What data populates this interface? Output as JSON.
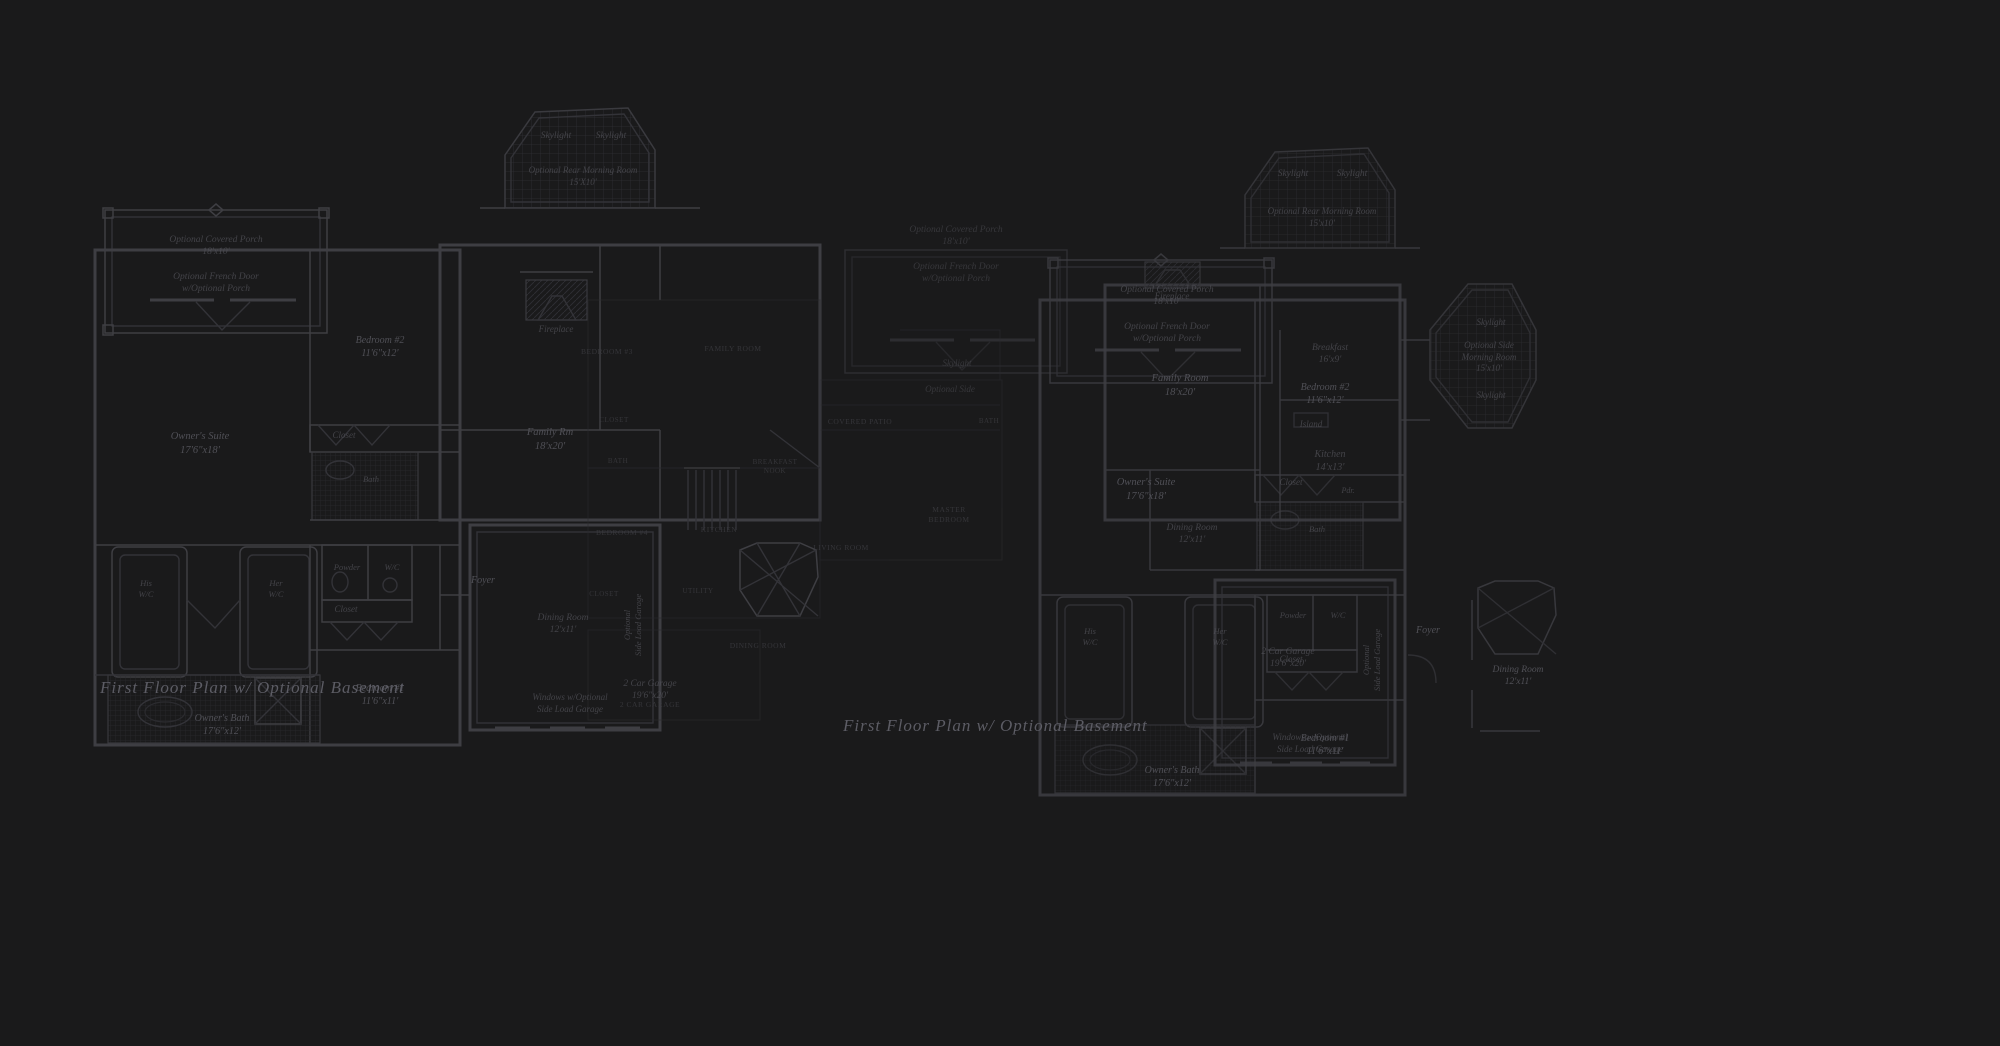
{
  "canvas": {
    "width": 2000,
    "height": 1046,
    "background_color": "#1a1a1b"
  },
  "colors": {
    "wall_line": "#3e3e43",
    "faint_line": "#2b2b2f",
    "label_text": "#53535a",
    "faint_caps_text": "#3c3c41",
    "title_text": "#62626b"
  },
  "plans": [
    {
      "name": "left-floor-plan",
      "title": "First Floor Plan  w/ Optional Basement",
      "title_pos": {
        "x": 100,
        "y": 678,
        "size": 17
      },
      "labels": [
        {
          "name": "covered-porch-label",
          "lines": [
            "Optional Covered Porch",
            "18'x10'"
          ],
          "x": 216,
          "y": 234,
          "size": 9.5,
          "cls": "med"
        },
        {
          "name": "french-door-label",
          "lines": [
            "Optional French Door",
            "w/Optional Porch"
          ],
          "x": 216,
          "y": 271,
          "size": 9.5,
          "cls": "med"
        },
        {
          "name": "bedroom-2-label",
          "lines": [
            "Bedroom #2",
            "11'6\"x12'"
          ],
          "x": 380,
          "y": 334,
          "size": 10,
          "cls": "strong"
        },
        {
          "name": "owners-suite-label",
          "lines": [
            "Owner's Suite",
            "17'6\"x18'"
          ],
          "x": 200,
          "y": 430,
          "size": 10.5,
          "cls": "strong"
        },
        {
          "name": "closet-bedroom2-label",
          "lines": [
            "Closet"
          ],
          "x": 344,
          "y": 430,
          "size": 9,
          "cls": "med"
        },
        {
          "name": "bath-label",
          "lines": [
            "Bath"
          ],
          "x": 371,
          "y": 474,
          "size": 8.5,
          "cls": "med"
        },
        {
          "name": "skylight-left-label",
          "lines": [
            "Skylight"
          ],
          "x": 556,
          "y": 130,
          "size": 9.5,
          "cls": "med"
        },
        {
          "name": "skylight-right-label",
          "lines": [
            "Skylight"
          ],
          "x": 611,
          "y": 130,
          "size": 9.5,
          "cls": "med"
        },
        {
          "name": "rear-morning-room-label",
          "lines": [
            "Optional Rear Morning Room",
            "15'X10'"
          ],
          "x": 583,
          "y": 165,
          "size": 9,
          "cls": "med"
        },
        {
          "name": "fireplace-label",
          "lines": [
            "Fireplace"
          ],
          "x": 556,
          "y": 324,
          "size": 9,
          "cls": "med"
        },
        {
          "name": "family-rm-label",
          "lines": [
            "Family Rm",
            "18'x20'"
          ],
          "x": 550,
          "y": 426,
          "size": 10.5,
          "cls": "strong"
        },
        {
          "name": "his-wc-label",
          "lines": [
            "His",
            "W/C"
          ],
          "x": 146,
          "y": 578,
          "size": 8.5,
          "cls": "med"
        },
        {
          "name": "her-wc-label",
          "lines": [
            "Her",
            "W/C"
          ],
          "x": 276,
          "y": 578,
          "size": 8.5,
          "cls": "med"
        },
        {
          "name": "powder-label",
          "lines": [
            "Powder"
          ],
          "x": 347,
          "y": 562,
          "size": 8.5,
          "cls": "med"
        },
        {
          "name": "wc-label",
          "lines": [
            "W/C"
          ],
          "x": 392,
          "y": 562,
          "size": 8.5,
          "cls": "med"
        },
        {
          "name": "closet-hall-label",
          "lines": [
            "Closet"
          ],
          "x": 346,
          "y": 604,
          "size": 9,
          "cls": "med"
        },
        {
          "name": "foyer-label",
          "lines": [
            "Foyer"
          ],
          "x": 483,
          "y": 574,
          "size": 10,
          "cls": "strong"
        },
        {
          "name": "dining-room-label",
          "lines": [
            "Dining Room",
            "12'x11'"
          ],
          "x": 563,
          "y": 612,
          "size": 9.5,
          "cls": "med"
        },
        {
          "name": "bedroom-1-label",
          "lines": [
            "Bedroom #1",
            "11'6\"x11'"
          ],
          "x": 380,
          "y": 682,
          "size": 10,
          "cls": "strong"
        },
        {
          "name": "owners-bath-label",
          "lines": [
            "Owner's Bath",
            "17'6\"x12'"
          ],
          "x": 222,
          "y": 712,
          "size": 10,
          "cls": "strong"
        },
        {
          "name": "garage-label",
          "lines": [
            "2 Car Garage",
            "19'6\"x20'"
          ],
          "x": 650,
          "y": 678,
          "size": 9.5,
          "cls": "med"
        },
        {
          "name": "side-load-garage-vertical-label",
          "lines": [
            "Optional",
            "Side Load Garage"
          ],
          "x": 633,
          "y": 625,
          "size": 8.5,
          "cls": "vertical med"
        },
        {
          "name": "windows-side-load-label",
          "lines": [
            "Windows w/Optional",
            "Side Load Garage"
          ],
          "x": 570,
          "y": 692,
          "size": 9,
          "cls": "med"
        }
      ]
    },
    {
      "name": "right-floor-plan",
      "title": "First Floor Plan  w/ Optional Basement",
      "title_pos": {
        "x": 843,
        "y": 716,
        "size": 17
      },
      "labels": [
        {
          "name": "covered-porch-label",
          "lines": [
            "Optional Covered Porch",
            "18'x10'"
          ],
          "x": 1167,
          "y": 284,
          "size": 9.5,
          "cls": "med"
        },
        {
          "name": "french-door-label",
          "lines": [
            "Optional French Door",
            "w/Optional Porch"
          ],
          "x": 1167,
          "y": 321,
          "size": 9.5,
          "cls": "med"
        },
        {
          "name": "covered-porch-2-label",
          "lines": [
            "Optional Covered Porch",
            "18'x10'"
          ],
          "x": 956,
          "y": 224,
          "size": 9.5,
          "cls": "faint"
        },
        {
          "name": "french-door-2-label",
          "lines": [
            "Optional French Door",
            "w/Optional Porch"
          ],
          "x": 956,
          "y": 261,
          "size": 9.5,
          "cls": "faint"
        },
        {
          "name": "bedroom-2-label",
          "lines": [
            "Bedroom #2",
            "11'6\"x12'"
          ],
          "x": 1325,
          "y": 381,
          "size": 10,
          "cls": "strong"
        },
        {
          "name": "owners-suite-label",
          "lines": [
            "Owner's Suite",
            "17'6\"x18'"
          ],
          "x": 1146,
          "y": 476,
          "size": 10.5,
          "cls": "strong"
        },
        {
          "name": "closet-bedroom2-label",
          "lines": [
            "Closet"
          ],
          "x": 1291,
          "y": 477,
          "size": 9,
          "cls": "med"
        },
        {
          "name": "bath-label",
          "lines": [
            "Bath"
          ],
          "x": 1317,
          "y": 524,
          "size": 8.5,
          "cls": "med"
        },
        {
          "name": "skylight-left-label",
          "lines": [
            "Skylight"
          ],
          "x": 1293,
          "y": 168,
          "size": 9.5,
          "cls": "med"
        },
        {
          "name": "skylight-right-label",
          "lines": [
            "Skylight"
          ],
          "x": 1352,
          "y": 168,
          "size": 9.5,
          "cls": "med"
        },
        {
          "name": "rear-morning-room-label",
          "lines": [
            "Optional Rear Morning Room",
            "15'x10'"
          ],
          "x": 1322,
          "y": 206,
          "size": 9,
          "cls": "med"
        },
        {
          "name": "fireplace-label",
          "lines": [
            "Fireplace"
          ],
          "x": 1172,
          "y": 291,
          "size": 9,
          "cls": "med"
        },
        {
          "name": "family-room-label",
          "lines": [
            "Family Room",
            "18'x20'"
          ],
          "x": 1180,
          "y": 372,
          "size": 10.5,
          "cls": "strong"
        },
        {
          "name": "breakfast-label",
          "lines": [
            "Breakfast",
            "16'x9'"
          ],
          "x": 1330,
          "y": 342,
          "size": 9.5,
          "cls": "med"
        },
        {
          "name": "island-label",
          "lines": [
            "Island"
          ],
          "x": 1311,
          "y": 419,
          "size": 9,
          "cls": "med"
        },
        {
          "name": "kitchen-label",
          "lines": [
            "Kitchen",
            "14'x13'"
          ],
          "x": 1330,
          "y": 448,
          "size": 10,
          "cls": "med"
        },
        {
          "name": "pdr-label",
          "lines": [
            "Pdr."
          ],
          "x": 1348,
          "y": 486,
          "size": 8,
          "cls": "med"
        },
        {
          "name": "side-morning-room-label",
          "lines": [
            "Optional Side",
            "Morning Room",
            "15'x10'"
          ],
          "x": 1489,
          "y": 340,
          "size": 9,
          "cls": "med"
        },
        {
          "name": "side-skylight-top-label",
          "lines": [
            "Skylight"
          ],
          "x": 1491,
          "y": 317,
          "size": 9,
          "cls": "med"
        },
        {
          "name": "side-skylight-bottom-label",
          "lines": [
            "Skylight"
          ],
          "x": 1491,
          "y": 390,
          "size": 9,
          "cls": "med"
        },
        {
          "name": "his-wc-label",
          "lines": [
            "His",
            "W/C"
          ],
          "x": 1090,
          "y": 626,
          "size": 8.5,
          "cls": "med"
        },
        {
          "name": "her-wc-label",
          "lines": [
            "Her",
            "W/C"
          ],
          "x": 1220,
          "y": 626,
          "size": 8.5,
          "cls": "med"
        },
        {
          "name": "powder-label",
          "lines": [
            "Powder"
          ],
          "x": 1293,
          "y": 610,
          "size": 8.5,
          "cls": "med"
        },
        {
          "name": "wc-label",
          "lines": [
            "W/C"
          ],
          "x": 1338,
          "y": 610,
          "size": 8.5,
          "cls": "med"
        },
        {
          "name": "closet-hall-label",
          "lines": [
            "Closet"
          ],
          "x": 1291,
          "y": 654,
          "size": 9,
          "cls": "med"
        },
        {
          "name": "foyer-label",
          "lines": [
            "Foyer"
          ],
          "x": 1428,
          "y": 624,
          "size": 10,
          "cls": "strong"
        },
        {
          "name": "dining-room-label",
          "lines": [
            "Dining Room",
            "12'x11'"
          ],
          "x": 1192,
          "y": 522,
          "size": 9.5,
          "cls": "med"
        },
        {
          "name": "dining-room-2-label",
          "lines": [
            "Dining Room",
            "12'x11'"
          ],
          "x": 1518,
          "y": 664,
          "size": 9.5,
          "cls": "strong"
        },
        {
          "name": "bedroom-1-label",
          "lines": [
            "Bedroom #1",
            "11'6\"x11'"
          ],
          "x": 1325,
          "y": 732,
          "size": 10,
          "cls": "strong"
        },
        {
          "name": "owners-bath-label",
          "lines": [
            "Owner's Bath",
            "17'6\"x12'"
          ],
          "x": 1172,
          "y": 764,
          "size": 10,
          "cls": "strong"
        },
        {
          "name": "garage-label",
          "lines": [
            "2 Car Garage",
            "19'6\"x20'"
          ],
          "x": 1288,
          "y": 646,
          "size": 9.5,
          "cls": "med"
        },
        {
          "name": "side-load-garage-vertical-label",
          "lines": [
            "Optional",
            "Side Load Garage"
          ],
          "x": 1372,
          "y": 660,
          "size": 8.5,
          "cls": "vertical med"
        },
        {
          "name": "windows-side-load-label",
          "lines": [
            "Windows w/Optional",
            "Side Load Garage"
          ],
          "x": 1310,
          "y": 732,
          "size": 9,
          "cls": "med"
        }
      ]
    }
  ],
  "faint_overlay_labels": [
    {
      "name": "family-room-faint-label",
      "lines": [
        "FAMILY ROOM"
      ],
      "x": 733,
      "y": 344,
      "size": 7.5,
      "cls": "caps"
    },
    {
      "name": "bedroom-faint-label",
      "lines": [
        "BEDROOM #3"
      ],
      "x": 607,
      "y": 347,
      "size": 7.5,
      "cls": "caps"
    },
    {
      "name": "closet-faint-label",
      "lines": [
        "CLOSET"
      ],
      "x": 614,
      "y": 416,
      "size": 7,
      "cls": "caps"
    },
    {
      "name": "bath-faint-label",
      "lines": [
        "BATH"
      ],
      "x": 618,
      "y": 457,
      "size": 7,
      "cls": "caps"
    },
    {
      "name": "breakfast-nook-faint-label",
      "lines": [
        "BREAKFAST",
        "NOOK"
      ],
      "x": 775,
      "y": 458,
      "size": 7,
      "cls": "caps"
    },
    {
      "name": "kitchen-faint-label",
      "lines": [
        "KITCHEN"
      ],
      "x": 719,
      "y": 525,
      "size": 7.5,
      "cls": "caps"
    },
    {
      "name": "bedroom-4-faint-label",
      "lines": [
        "BEDROOM #4"
      ],
      "x": 622,
      "y": 528,
      "size": 7.5,
      "cls": "caps"
    },
    {
      "name": "utility-faint-label",
      "lines": [
        "UTILITY"
      ],
      "x": 698,
      "y": 587,
      "size": 7,
      "cls": "caps"
    },
    {
      "name": "closet-2-faint-label",
      "lines": [
        "CLOSET"
      ],
      "x": 604,
      "y": 590,
      "size": 7,
      "cls": "caps"
    },
    {
      "name": "dining-room-faint-label",
      "lines": [
        "DINING ROOM"
      ],
      "x": 758,
      "y": 641,
      "size": 7.5,
      "cls": "caps"
    },
    {
      "name": "garage-faint-label",
      "lines": [
        "2 CAR GARAGE"
      ],
      "x": 650,
      "y": 700,
      "size": 7.5,
      "cls": "caps"
    },
    {
      "name": "covered-patio-faint-label",
      "lines": [
        "COVERED PATIO"
      ],
      "x": 860,
      "y": 417,
      "size": 7.5,
      "cls": "caps"
    },
    {
      "name": "bath-2-faint-label",
      "lines": [
        "BATH"
      ],
      "x": 989,
      "y": 417,
      "size": 7,
      "cls": "caps"
    },
    {
      "name": "master-bedroom-faint-label",
      "lines": [
        "MASTER",
        "BEDROOM"
      ],
      "x": 949,
      "y": 505,
      "size": 7.5,
      "cls": "caps"
    },
    {
      "name": "living-room-faint-label",
      "lines": [
        "LIVING ROOM"
      ],
      "x": 841,
      "y": 543,
      "size": 7.5,
      "cls": "caps"
    },
    {
      "name": "skylight-faint-label",
      "lines": [
        "Skylight"
      ],
      "x": 957,
      "y": 358,
      "size": 9,
      "cls": "faint"
    },
    {
      "name": "optional-side-faint-label",
      "lines": [
        "Optional Side"
      ],
      "x": 950,
      "y": 384,
      "size": 9,
      "cls": "faint"
    }
  ]
}
